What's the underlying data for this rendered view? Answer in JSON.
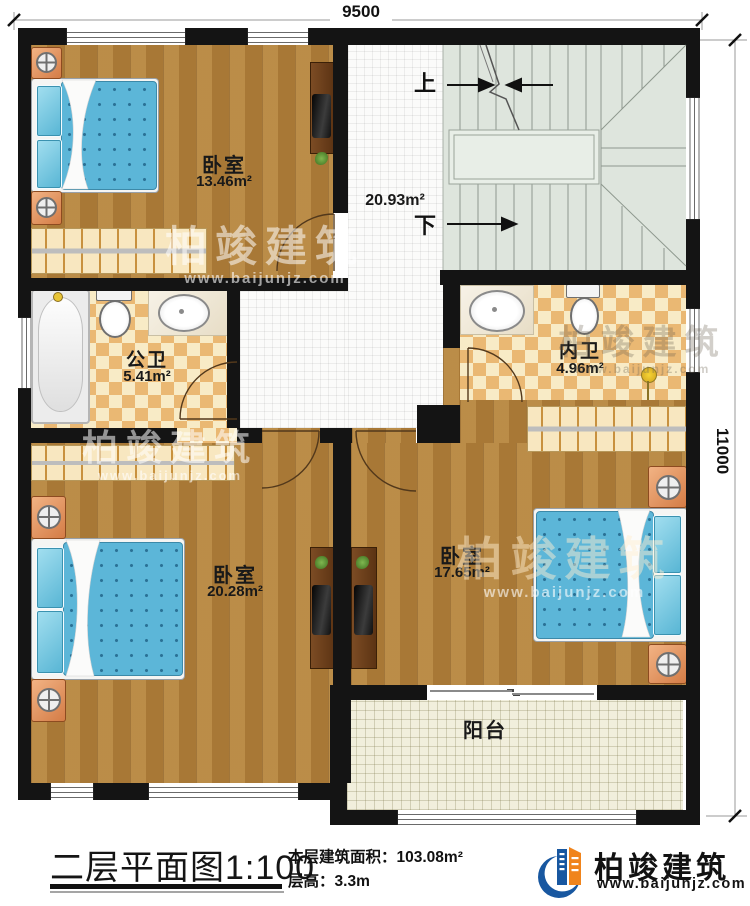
{
  "dimensions": {
    "top": "9500",
    "right": "11000"
  },
  "rooms": {
    "bedroom_top": {
      "name": "卧室",
      "area": "13.46m²"
    },
    "hallway": {
      "area": "20.93m²"
    },
    "public_bath": {
      "name": "公卫",
      "area": "5.41m²"
    },
    "ensuite_bath": {
      "name": "内卫",
      "area": "4.96m²"
    },
    "bedroom_left": {
      "name": "卧室",
      "area": "20.28m²"
    },
    "bedroom_right": {
      "name": "卧室",
      "area": "17.65m²"
    },
    "balcony": {
      "name": "阳台"
    }
  },
  "stairs": {
    "up_label": "上",
    "down_label": "下"
  },
  "title_block": {
    "title": "二层平面图1:100",
    "area_label": "本层建筑面积：",
    "area_value": "103.08m²",
    "floor_height_label": "层高：",
    "floor_height_value": "3.3m"
  },
  "brand": {
    "name": "柏竣建筑",
    "website": "www.baijunjz.com"
  },
  "watermark": {
    "name": "柏竣建筑",
    "website": "www.baijunjz.com"
  },
  "colors": {
    "wall": "#141414",
    "wood": "#b2813c",
    "checker": "#eab873",
    "stair": "#dee5dd",
    "brand_blue": "#1857a0",
    "brand_orange": "#f0841c"
  }
}
